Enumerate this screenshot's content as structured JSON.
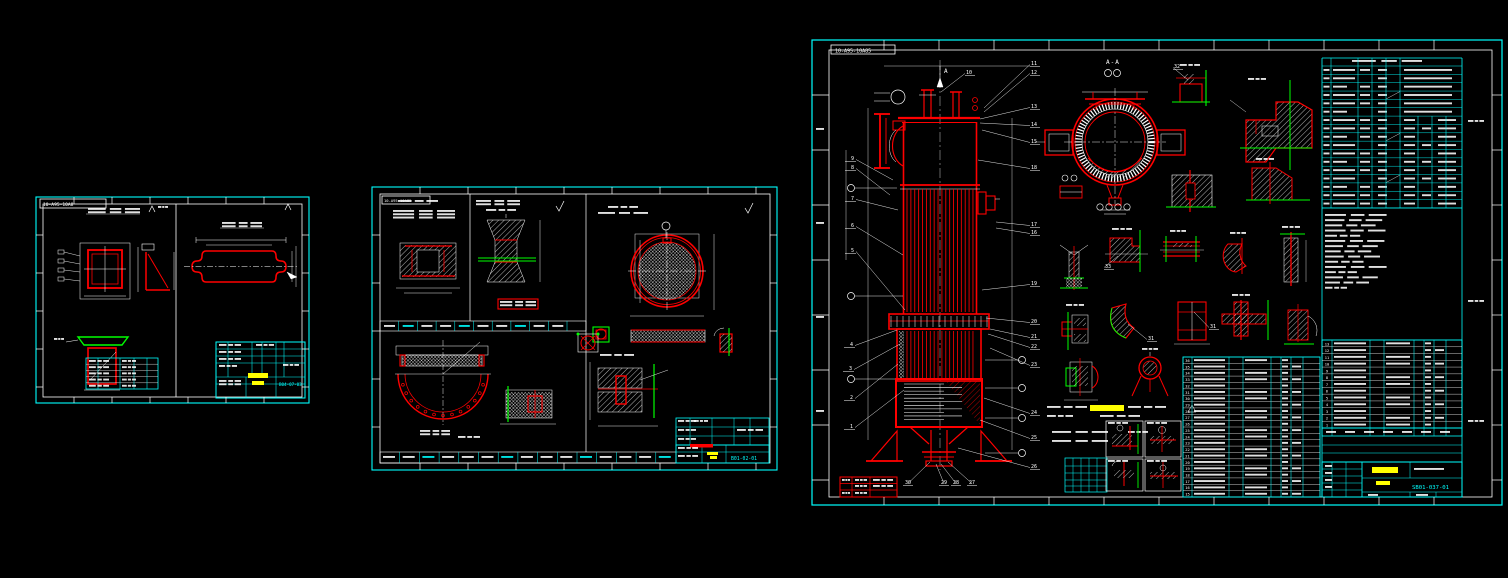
{
  "app": {
    "type": "cad-viewport",
    "background": "#000000"
  },
  "colors": {
    "background": "#000000",
    "line_white": "#ffffff",
    "entity_red": "#ff0000",
    "frame_cyan": "#00ffff",
    "highlight_green": "#00ff00",
    "highlight_yellow": "#ffff00"
  },
  "sheets": {
    "left": {
      "tag": "10-A95-10A8",
      "drawing_number": "B04-07-03"
    },
    "middle": {
      "tag": "10-A95-10A85",
      "drawing_number": "B01-02-01"
    },
    "right": {
      "tag": "10-A95-10A85",
      "drawing_number": "SB01-037-01",
      "view_label": "A",
      "section_label": "A-A",
      "callouts": [
        {
          "n": "9",
          "x": 854,
          "y": 158,
          "tx": 893,
          "ty": 180
        },
        {
          "n": "8",
          "x": 854,
          "y": 167,
          "tx": 890,
          "ty": 195
        },
        {
          "n": "7",
          "x": 854,
          "y": 198,
          "tx": 898,
          "ty": 210
        },
        {
          "n": "6",
          "x": 854,
          "y": 225,
          "tx": 903,
          "ty": 255
        },
        {
          "n": "5",
          "x": 854,
          "y": 250,
          "tx": 905,
          "ty": 310
        },
        {
          "n": "4",
          "x": 853,
          "y": 344,
          "tx": 897,
          "ty": 330
        },
        {
          "n": "3",
          "x": 852,
          "y": 368,
          "tx": 900,
          "ty": 344
        },
        {
          "n": "2",
          "x": 853,
          "y": 397,
          "tx": 898,
          "ty": 364
        },
        {
          "n": "1",
          "x": 853,
          "y": 426,
          "tx": 904,
          "ty": 390
        },
        {
          "n": "10",
          "x": 966,
          "y": 72,
          "tx": 941,
          "ty": 92
        },
        {
          "n": "11",
          "x": 1031,
          "y": 63,
          "tx": 984,
          "ty": 108
        },
        {
          "n": "12",
          "x": 1031,
          "y": 72,
          "tx": 984,
          "ty": 112
        },
        {
          "n": "13",
          "x": 1031,
          "y": 106,
          "tx": 980,
          "ty": 119
        },
        {
          "n": "14",
          "x": 1031,
          "y": 124,
          "tx": 980,
          "ty": 123
        },
        {
          "n": "15",
          "x": 1031,
          "y": 141,
          "tx": 982,
          "ty": 130
        },
        {
          "n": "18",
          "x": 1031,
          "y": 167,
          "tx": 978,
          "ty": 160
        },
        {
          "n": "17",
          "x": 1031,
          "y": 224,
          "tx": 996,
          "ty": 222
        },
        {
          "n": "16",
          "x": 1031,
          "y": 232,
          "tx": 996,
          "ty": 228
        },
        {
          "n": "19",
          "x": 1031,
          "y": 283,
          "tx": 982,
          "ty": 290
        },
        {
          "n": "20",
          "x": 1031,
          "y": 321,
          "tx": 986,
          "ty": 318
        },
        {
          "n": "21",
          "x": 1031,
          "y": 336,
          "tx": 990,
          "ty": 329
        },
        {
          "n": "22",
          "x": 1031,
          "y": 346,
          "tx": 988,
          "ty": 334
        },
        {
          "n": "23",
          "x": 1031,
          "y": 364,
          "tx": 990,
          "ty": 348
        },
        {
          "n": "24",
          "x": 1031,
          "y": 412,
          "tx": 984,
          "ty": 398
        },
        {
          "n": "25",
          "x": 1031,
          "y": 437,
          "tx": 980,
          "ty": 420
        },
        {
          "n": "26",
          "x": 1031,
          "y": 466,
          "tx": 958,
          "ty": 448
        },
        {
          "n": "30",
          "x": 908,
          "y": 482,
          "tx": 930,
          "ty": 462
        },
        {
          "n": "29",
          "x": 944,
          "y": 482,
          "tx": 936,
          "ty": 464
        },
        {
          "n": "28",
          "x": 956,
          "y": 482,
          "tx": 941,
          "ty": 464
        },
        {
          "n": "27",
          "x": 972,
          "y": 482,
          "tx": 948,
          "ty": 462
        }
      ],
      "detail_callouts": [
        {
          "n": "31",
          "x": 1148,
          "y": 338,
          "tx": 1128,
          "ty": 324
        },
        {
          "n": "31",
          "x": 1210,
          "y": 326,
          "tx": 1194,
          "ty": 312
        },
        {
          "n": "32",
          "x": 1174,
          "y": 66,
          "tx": 1188,
          "ty": 80
        },
        {
          "n": "33",
          "x": 1105,
          "y": 266,
          "tx": 1118,
          "ty": 256
        }
      ],
      "bom_left_rows": [
        "36",
        "35",
        "34",
        "33",
        "32",
        "31",
        "30",
        "29",
        "28",
        "27",
        "26",
        "25",
        "24",
        "23",
        "22",
        "21",
        "20",
        "19",
        "18",
        "17",
        "16",
        "15"
      ],
      "bom_right_rows": [
        "13",
        "12",
        "11",
        "10",
        "9",
        "8",
        "7",
        "6",
        "5",
        "4",
        "3",
        "2",
        "1"
      ]
    }
  }
}
